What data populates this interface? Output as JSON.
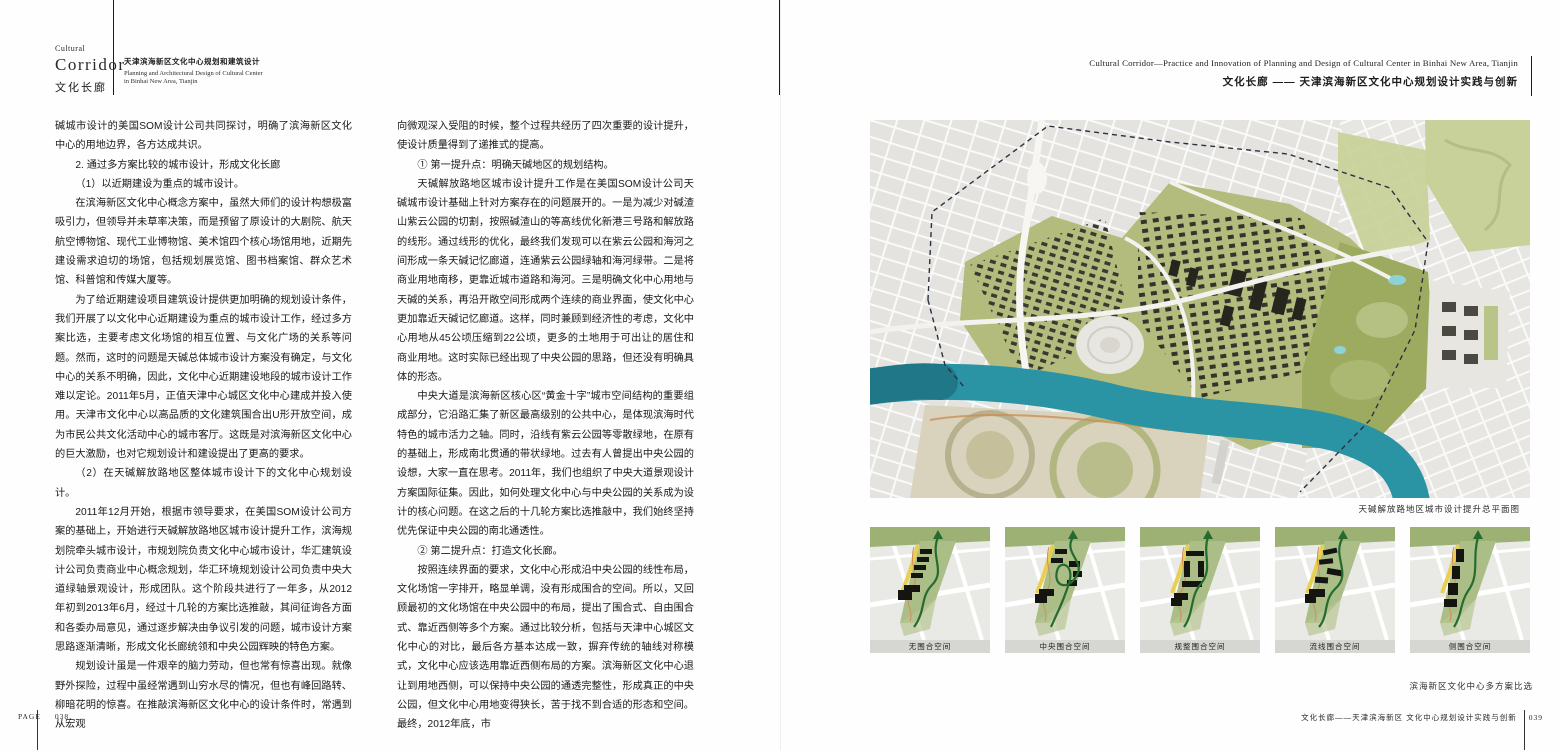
{
  "left_page": {
    "masthead": {
      "kicker": "Cultural",
      "title": "Corridor",
      "title_zh": "文化长廊",
      "subtitle_zh": "天津滨海新区文化中心规划和建筑设计",
      "subtitle_en_line1": "Planning and Architectural Design of Cultural Center",
      "subtitle_en_line2": "in Binhai New Area, Tianjin"
    },
    "column1": [
      {
        "t": "碱城市设计的美国SOM设计公司共同探讨，明确了滨海新区文化中心的用地边界，各方达成共识。",
        "cont": true
      },
      {
        "t": "2. 通过多方案比较的城市设计，形成文化长廊"
      },
      {
        "t": "（1）以近期建设为重点的城市设计。"
      },
      {
        "t": "在滨海新区文化中心概念方案中，虽然大师们的设计构想极富吸引力，但领导并未草率决策，而是预留了原设计的大剧院、航天航空博物馆、现代工业博物馆、美术馆四个核心场馆用地，近期先建设需求迫切的场馆，包括规划展览馆、图书档案馆、群众艺术馆、科普馆和传媒大厦等。"
      },
      {
        "t": "为了给近期建设项目建筑设计提供更加明确的规划设计条件，我们开展了以文化中心近期建设为重点的城市设计工作，经过多方案比选，主要考虑文化场馆的相互位置、与文化广场的关系等问题。然而，这时的问题是天碱总体城市设计方案没有确定，与文化中心的关系不明确，因此，文化中心近期建设地段的城市设计工作难以定论。2011年5月，正值天津中心城区文化中心建成并投入使用。天津市文化中心以高品质的文化建筑围合出U形开放空间，成为市民公共文化活动中心的城市客厅。这既是对滨海新区文化中心的巨大激励，也对它规划设计和建设提出了更高的要求。"
      },
      {
        "t": "（2）在天碱解放路地区整体城市设计下的文化中心规划设计。"
      },
      {
        "t": "2011年12月开始，根据市领导要求，在美国SOM设计公司方案的基础上，开始进行天碱解放路地区城市设计提升工作，滨海规划院牵头城市设计，市规划院负责文化中心城市设计，华汇建筑设计公司负责商业中心概念规划，华汇环境规划设计公司负责中央大道绿轴景观设计，形成团队。这个阶段共进行了一年多，从2012年初到2013年6月，经过十几轮的方案比选推敲，其间征询各方面和各委办局意见，通过逐步解决由争议引发的问题，城市设计方案思路逐渐清晰，形成文化长廊统领和中央公园辉映的特色方案。"
      },
      {
        "t": "规划设计虽是一件艰辛的脑力劳动，但也常有惊喜出现。就像野外探险，过程中虽经常遇到山穷水尽的情况，但也有峰回路转、柳暗花明的惊喜。在推敲滨海新区文化中心的设计条件时，常遇到从宏观"
      }
    ],
    "column2": [
      {
        "t": "向微观深入受阻的时候，整个过程共经历了四次重要的设计提升，使设计质量得到了递推式的提高。",
        "cont": true
      },
      {
        "t": "① 第一提升点：明确天碱地区的规划结构。"
      },
      {
        "t": "天碱解放路地区城市设计提升工作是在美国SOM设计公司天碱城市设计基础上针对方案存在的问题展开的。一是为减少对碱渣山紫云公园的切割，按照碱渣山的等高线优化新港三号路和解放路的线形。通过线形的优化，最终我们发现可以在紫云公园和海河之间形成一条天碱记忆廊道，连通紫云公园绿轴和海河绿带。二是将商业用地南移，更靠近城市道路和海河。三是明确文化中心用地与天碱的关系，再沿开敞空间形成两个连续的商业界面，使文化中心更加靠近天碱记忆廊道。这样，同时兼顾到经济性的考虑，文化中心用地从45公顷压缩到22公顷，更多的土地用于可出让的居住和商业用地。这时实际已经出现了中央公园的思路，但还没有明确具体的形态。"
      },
      {
        "t": "中央大道是滨海新区核心区“黄金十字”城市空间结构的重要组成部分，它沿路汇集了新区最高级别的公共中心，是体现滨海时代特色的城市活力之轴。同时，沿线有紫云公园等零散绿地，在原有的基础上，形成南北贯通的带状绿地。过去有人曾提出中央公园的设想，大家一直在思考。2011年，我们也组织了中央大道景观设计方案国际征集。因此，如何处理文化中心与中央公园的关系成为设计的核心问题。在这之后的十几轮方案比选推敲中，我们始终坚持优先保证中央公园的南北通透性。"
      },
      {
        "t": "② 第二提升点：打造文化长廊。"
      },
      {
        "t": "按照连续界面的要求，文化中心形成沿中央公园的线性布局，文化场馆一字排开，略显单调，没有形成围合的空间。所以，又回顾最初的文化场馆在中央公园中的布局，提出了围合式、自由围合式、靠近西侧等多个方案。通过比较分析，包括与天津中心城区文化中心的对比，最后各方基本达成一致，摒弃传统的轴线对称模式，文化中心应该选用靠近西侧布局的方案。滨海新区文化中心退让到用地西侧，可以保持中央公园的通透完整性，形成真正的中央公园，但文化中心用地变得狭长，苦于找不到合适的形态和空间。最终，2012年底，市"
      }
    ],
    "footer": {
      "label": "PAGE",
      "page_number": "038"
    }
  },
  "right_page": {
    "header": {
      "title_en": "Cultural Corridor—Practice and Innovation of Planning and Design of Cultural Center in Binhai New Area, Tianjin",
      "title_zh": "文化长廊 —— 天津滨海新区文化中心规划设计实践与创新"
    },
    "masterplan": {
      "caption": "天碱解放路地区城市设计提升总平面图"
    },
    "schemes": {
      "items": [
        {
          "caption": "无围合空间"
        },
        {
          "caption": "中央围合空间"
        },
        {
          "caption": "规整围合空间"
        },
        {
          "caption": "流线围合空间"
        },
        {
          "caption": "侧围合空间"
        }
      ],
      "caption": "滨海新区文化中心多方案比选"
    },
    "footer": {
      "title": "文化长廊——天津滨海新区 文化中心规划设计实践与创新",
      "page_number": "039"
    }
  },
  "palette": {
    "river_teal": "#2a93a4",
    "park_green": "#a9bd85",
    "district_olive": "#b3bc7d",
    "building_dark": "#2f2f2a",
    "route_green": "#256b2f",
    "highlight_yellow": "#e8cf52"
  }
}
